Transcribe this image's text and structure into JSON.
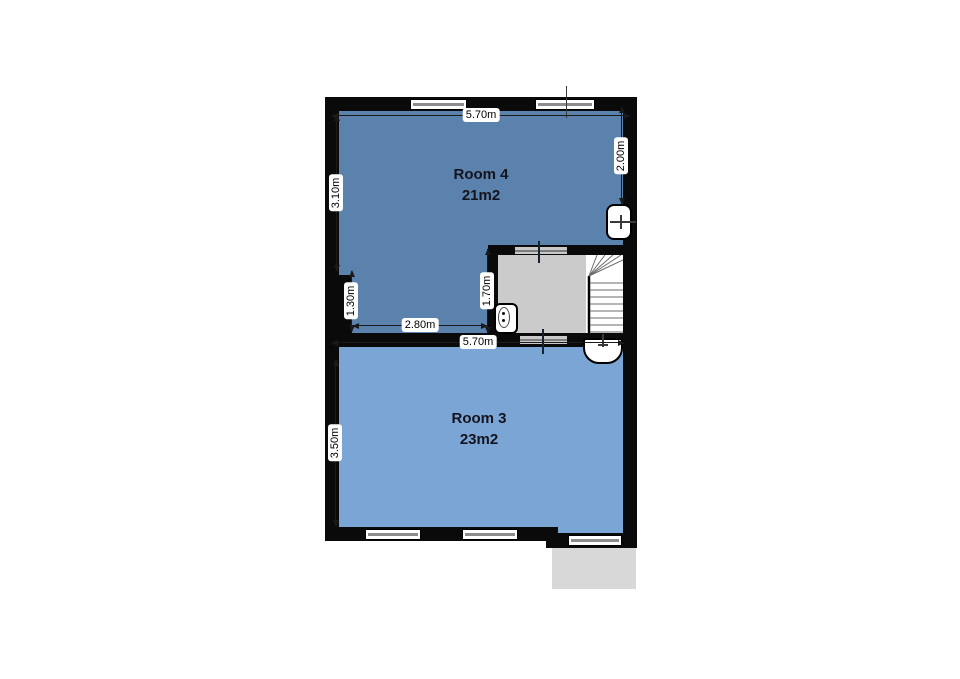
{
  "plan_title": "floor-plan-upper-level",
  "rooms": [
    {
      "name": "Room 4",
      "area": "21m2",
      "color": "#5b82ac"
    },
    {
      "name": "Room 3",
      "area": "23m2",
      "color": "#7aa5d5"
    }
  ],
  "dimensions": {
    "room4_top_width": "5.70m",
    "room4_left_height": "3.10m",
    "room4_right_height": "2.00m",
    "chimney_height": "1.30m",
    "room4_bottom_width": "2.80m",
    "stairwell_height": "1.70m",
    "room3_top_width": "5.70m",
    "room3_left_height": "3.50m"
  },
  "fixtures": {
    "room4_sink": "sink",
    "stairwell_toilet": "toilet",
    "room3_sink": "sink",
    "stairs": "winder-staircase"
  },
  "colors": {
    "wall": "#0a0a0a",
    "room4_fill": "#5b82ac",
    "room3_fill": "#7aa5d5",
    "landing_fill": "#cbcbcb",
    "balcony_fill": "#d8d8d8",
    "dimension_line": "#1a1a1a"
  }
}
